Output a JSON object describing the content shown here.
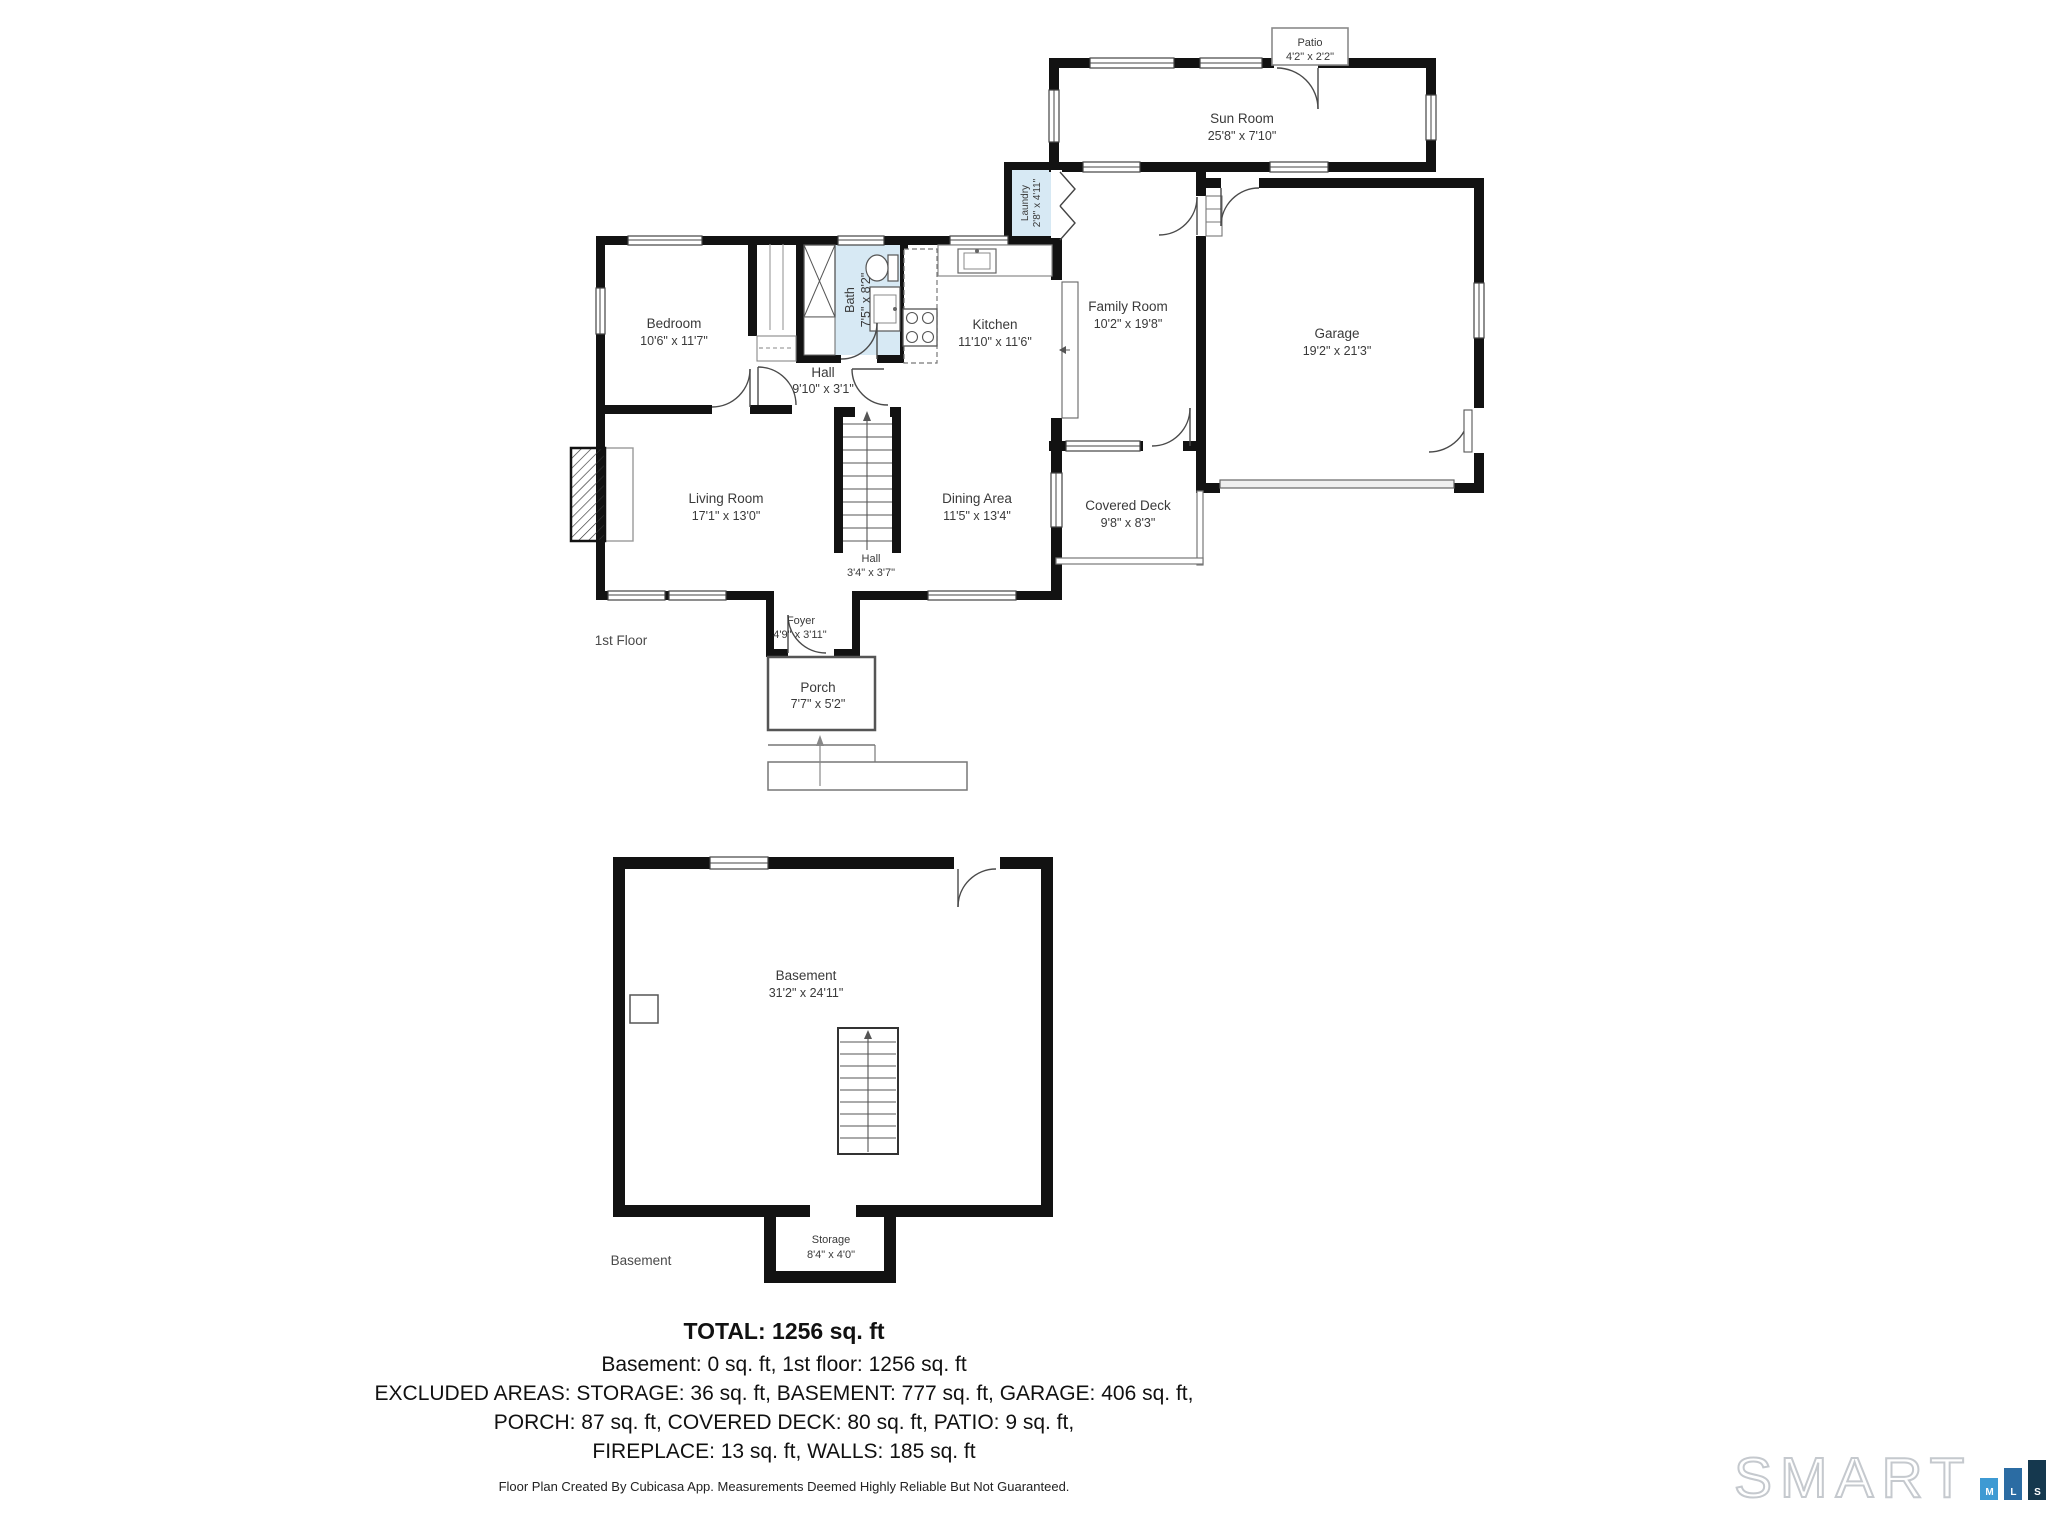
{
  "floor1": {
    "floor_label": "1st Floor",
    "rooms": {
      "patio": {
        "name": "Patio",
        "dims": "4'2\" x 2'2\""
      },
      "sun_room": {
        "name": "Sun Room",
        "dims": "25'8\" x 7'10\""
      },
      "laundry": {
        "name": "Laundry",
        "dims": "2'8\" x 4'11\""
      },
      "bedroom": {
        "name": "Bedroom",
        "dims": "10'6\" x 11'7\""
      },
      "bath": {
        "name": "Bath",
        "dims": "7'5\" x 8'2\""
      },
      "kitchen": {
        "name": "Kitchen",
        "dims": "11'10\" x 11'6\""
      },
      "family_room": {
        "name": "Family Room",
        "dims": "10'2\" x 19'8\""
      },
      "garage": {
        "name": "Garage",
        "dims": "19'2\" x 21'3\""
      },
      "hall_upper": {
        "name": "Hall",
        "dims": "9'10\" x 3'1\""
      },
      "living_room": {
        "name": "Living Room",
        "dims": "17'1\" x 13'0\""
      },
      "dining_area": {
        "name": "Dining Area",
        "dims": "11'5\" x 13'4\""
      },
      "covered_deck": {
        "name": "Covered Deck",
        "dims": "9'8\" x 8'3\""
      },
      "hall_lower": {
        "name": "Hall",
        "dims": "3'4\" x 3'7\""
      },
      "foyer": {
        "name": "Foyer",
        "dims": "4'9\" x 3'11\""
      },
      "porch": {
        "name": "Porch",
        "dims": "7'7\" x 5'2\""
      }
    }
  },
  "basement_floor": {
    "floor_label": "Basement",
    "rooms": {
      "basement": {
        "name": "Basement",
        "dims": "31'2\" x 24'11\""
      },
      "storage": {
        "name": "Storage",
        "dims": "8'4\" x 4'0\""
      }
    }
  },
  "summary": {
    "total": "TOTAL: 1256 sq. ft",
    "line1": "Basement: 0 sq. ft, 1st floor: 1256 sq. ft",
    "line2": "EXCLUDED AREAS: STORAGE: 36 sq. ft, BASEMENT: 777 sq. ft, GARAGE: 406 sq. ft,",
    "line3": "PORCH: 87 sq. ft, COVERED DECK: 80 sq. ft, PATIO: 9 sq. ft,",
    "line4": "FIREPLACE: 13 sq. ft, WALLS: 185 sq. ft",
    "disclaimer": "Floor Plan Created By Cubicasa App. Measurements Deemed Highly Reliable But Not Guaranteed."
  },
  "logo": {
    "brand": "SMART",
    "m": "M",
    "l": "L",
    "s": "S"
  },
  "colors": {
    "wet_room": "#d7e9f4",
    "wall": "#121212",
    "label": "#3a3a3a",
    "logo_m": "#3e9ad3",
    "logo_l": "#2b6ca3",
    "logo_s": "#15384e"
  }
}
